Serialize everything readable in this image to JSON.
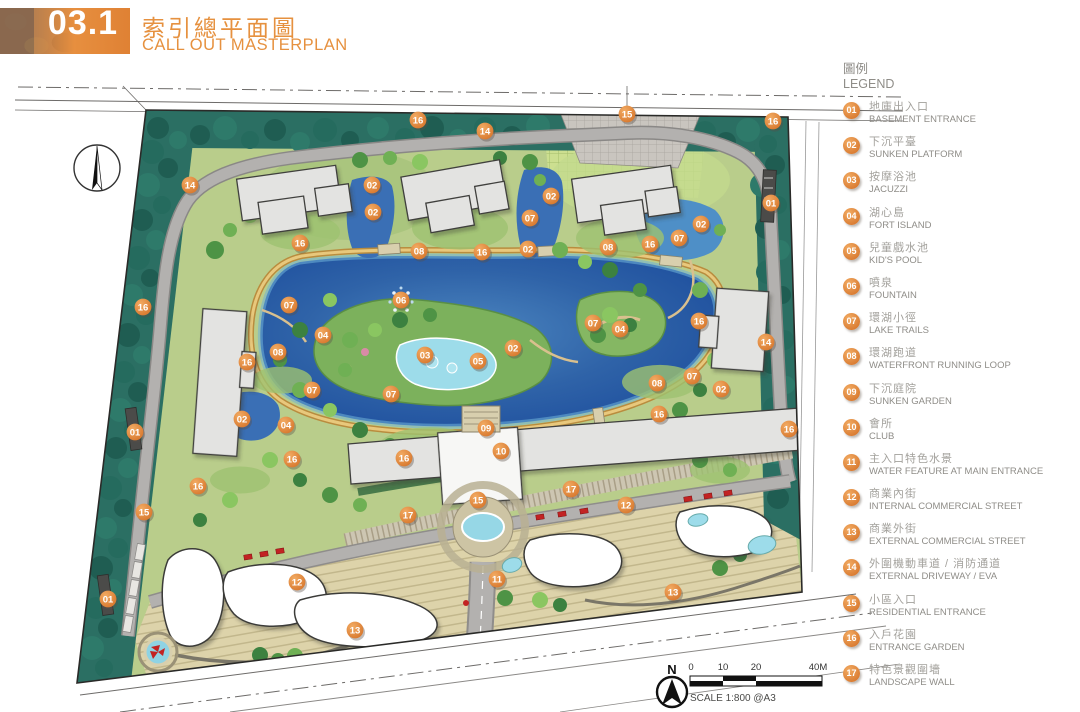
{
  "header": {
    "section_number": "03.1",
    "title_zh": "索引總平面圖",
    "title_en": "CALL OUT MASTERPLAN"
  },
  "legend": {
    "title_zh": "圖例",
    "title_en": "LEGEND",
    "items": [
      {
        "num": "01",
        "zh": "地庫出入口",
        "en": "BASEMENT ENTRANCE"
      },
      {
        "num": "02",
        "zh": "下沉平臺",
        "en": "SUNKEN PLATFORM"
      },
      {
        "num": "03",
        "zh": "按摩浴池",
        "en": "JACUZZI"
      },
      {
        "num": "04",
        "zh": "湖心島",
        "en": "FORT ISLAND"
      },
      {
        "num": "05",
        "zh": "兒童戲水池",
        "en": "KID'S POOL"
      },
      {
        "num": "06",
        "zh": "噴泉",
        "en": "FOUNTAIN"
      },
      {
        "num": "07",
        "zh": "環湖小徑",
        "en": "LAKE TRAILS"
      },
      {
        "num": "08",
        "zh": "環湖跑道",
        "en": "WATERFRONT RUNNING LOOP"
      },
      {
        "num": "09",
        "zh": "下沉庭院",
        "en": "SUNKEN GARDEN"
      },
      {
        "num": "10",
        "zh": "會所",
        "en": "CLUB"
      },
      {
        "num": "11",
        "zh": "主入口特色水景",
        "en": "WATER FEATURE AT MAIN ENTRANCE"
      },
      {
        "num": "12",
        "zh": "商業內街",
        "en": "INTERNAL COMMERCIAL STREET"
      },
      {
        "num": "13",
        "zh": "商業外街",
        "en": "EXTERNAL COMMERCIAL STREET"
      },
      {
        "num": "14",
        "zh": "外圍機動車道 / 消防通道",
        "en": "EXTERNAL DRIVEWAY / EVA"
      },
      {
        "num": "15",
        "zh": "小區入口",
        "en": "RESIDENTIAL ENTRANCE"
      },
      {
        "num": "16",
        "zh": "入戶花園",
        "en": "ENTRANCE GARDEN"
      },
      {
        "num": "17",
        "zh": "特色景觀圍墻",
        "en": "LANDSCAPE WALL"
      }
    ]
  },
  "plan": {
    "north_label": "N",
    "scale_text": "SCALE 1:800 @A3",
    "scale_ticks": [
      "0",
      "10",
      "20",
      "40M"
    ],
    "markers": [
      {
        "n": "01",
        "x": 771,
        "y": 203
      },
      {
        "n": "01",
        "x": 135,
        "y": 432
      },
      {
        "n": "01",
        "x": 108,
        "y": 599
      },
      {
        "n": "02",
        "x": 372,
        "y": 185
      },
      {
        "n": "02",
        "x": 373,
        "y": 212
      },
      {
        "n": "02",
        "x": 551,
        "y": 196
      },
      {
        "n": "02",
        "x": 528,
        "y": 249
      },
      {
        "n": "02",
        "x": 701,
        "y": 224
      },
      {
        "n": "02",
        "x": 513,
        "y": 348
      },
      {
        "n": "02",
        "x": 242,
        "y": 419
      },
      {
        "n": "02",
        "x": 721,
        "y": 389
      },
      {
        "n": "03",
        "x": 425,
        "y": 355
      },
      {
        "n": "04",
        "x": 323,
        "y": 335
      },
      {
        "n": "04",
        "x": 620,
        "y": 329
      },
      {
        "n": "04",
        "x": 286,
        "y": 425
      },
      {
        "n": "05",
        "x": 478,
        "y": 361
      },
      {
        "n": "06",
        "x": 401,
        "y": 300
      },
      {
        "n": "07",
        "x": 530,
        "y": 218
      },
      {
        "n": "07",
        "x": 679,
        "y": 238
      },
      {
        "n": "07",
        "x": 289,
        "y": 305
      },
      {
        "n": "07",
        "x": 593,
        "y": 323
      },
      {
        "n": "07",
        "x": 692,
        "y": 376
      },
      {
        "n": "07",
        "x": 312,
        "y": 390
      },
      {
        "n": "07",
        "x": 391,
        "y": 394
      },
      {
        "n": "08",
        "x": 419,
        "y": 251
      },
      {
        "n": "08",
        "x": 608,
        "y": 247
      },
      {
        "n": "08",
        "x": 278,
        "y": 352
      },
      {
        "n": "08",
        "x": 657,
        "y": 383
      },
      {
        "n": "09",
        "x": 486,
        "y": 428
      },
      {
        "n": "10",
        "x": 501,
        "y": 451
      },
      {
        "n": "11",
        "x": 497,
        "y": 579
      },
      {
        "n": "12",
        "x": 626,
        "y": 505
      },
      {
        "n": "12",
        "x": 297,
        "y": 582
      },
      {
        "n": "13",
        "x": 673,
        "y": 592
      },
      {
        "n": "13",
        "x": 355,
        "y": 630
      },
      {
        "n": "14",
        "x": 485,
        "y": 131
      },
      {
        "n": "14",
        "x": 190,
        "y": 185
      },
      {
        "n": "14",
        "x": 766,
        "y": 342
      },
      {
        "n": "15",
        "x": 627,
        "y": 114
      },
      {
        "n": "15",
        "x": 478,
        "y": 500
      },
      {
        "n": "15",
        "x": 144,
        "y": 512
      },
      {
        "n": "16",
        "x": 418,
        "y": 120
      },
      {
        "n": "16",
        "x": 773,
        "y": 121
      },
      {
        "n": "16",
        "x": 650,
        "y": 244
      },
      {
        "n": "16",
        "x": 300,
        "y": 243
      },
      {
        "n": "16",
        "x": 482,
        "y": 252
      },
      {
        "n": "16",
        "x": 143,
        "y": 307
      },
      {
        "n": "16",
        "x": 699,
        "y": 321
      },
      {
        "n": "16",
        "x": 247,
        "y": 362
      },
      {
        "n": "16",
        "x": 659,
        "y": 414
      },
      {
        "n": "16",
        "x": 404,
        "y": 458
      },
      {
        "n": "16",
        "x": 292,
        "y": 459
      },
      {
        "n": "16",
        "x": 198,
        "y": 486
      },
      {
        "n": "16",
        "x": 789,
        "y": 429
      },
      {
        "n": "17",
        "x": 571,
        "y": 489
      },
      {
        "n": "17",
        "x": 408,
        "y": 515
      }
    ]
  },
  "colors": {
    "accent_orange": "#E2873D",
    "title_orange": "#E6913F",
    "lake_blue": "#2E5FA5",
    "lake_light": "#9DDCEA",
    "forest_teal": "#2B6F63",
    "lawn_green": "#AFCB7D",
    "building_gray": "#E3E3E1",
    "commercial_beige": "#DDD3AA",
    "road_gray": "#B3B1AF"
  }
}
